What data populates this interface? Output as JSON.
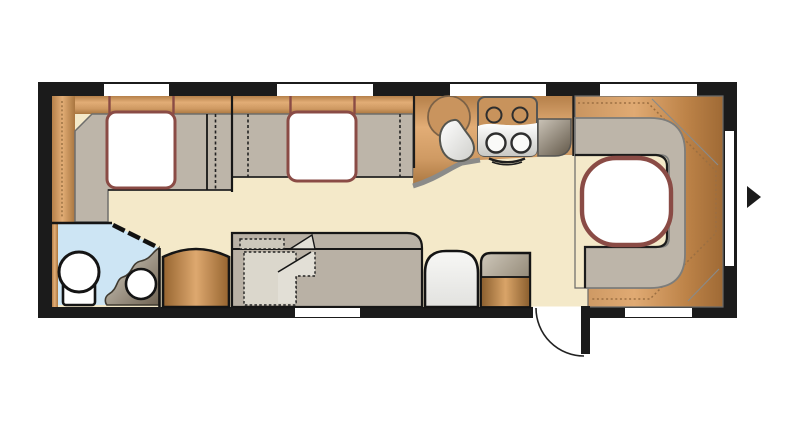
{
  "diagram": {
    "type": "caravan-floorplan",
    "orientation": "side-profile-top-view",
    "features": [
      {
        "name": "front-offside-sofa-with-cushion"
      },
      {
        "name": "front-nearside-sofa-with-cushion"
      },
      {
        "name": "kitchen-worktop"
      },
      {
        "name": "kitchen-sink-round"
      },
      {
        "name": "hob-four-burner"
      },
      {
        "name": "rear-u-shaped-lounge"
      },
      {
        "name": "rear-table"
      },
      {
        "name": "washroom-with-toilet-and-basin"
      },
      {
        "name": "wardrobe"
      },
      {
        "name": "convertible-side-bed-folded"
      },
      {
        "name": "side-unit-white"
      },
      {
        "name": "storage-cabinet"
      },
      {
        "name": "entrance-door-open-with-swing-arc"
      },
      {
        "name": "direction-arrow-right"
      }
    ],
    "window_count": 7
  },
  "palette": {
    "wall": "#1b1b1b",
    "floor": "#f4e9c9",
    "wood_mid": "#cf9a63",
    "wood_light": "#e2ad76",
    "wood_dark": "#a9763f",
    "upholstery": "#bdb5a9",
    "upholstery_dark": "#b9b1a5",
    "cushion_fill": "#ffffff",
    "cushion_border": "#8a4b45",
    "table_border": "#8a4b45",
    "washroom_floor": "#cde5f4",
    "vanity_dark": "#6f6352",
    "vanity_light": "#d8d2c6",
    "outline": "#161616",
    "dotted_wood_line": "#9b6f42",
    "fold_light": "#e2dfd6",
    "arrow": "#1b1b1b"
  }
}
